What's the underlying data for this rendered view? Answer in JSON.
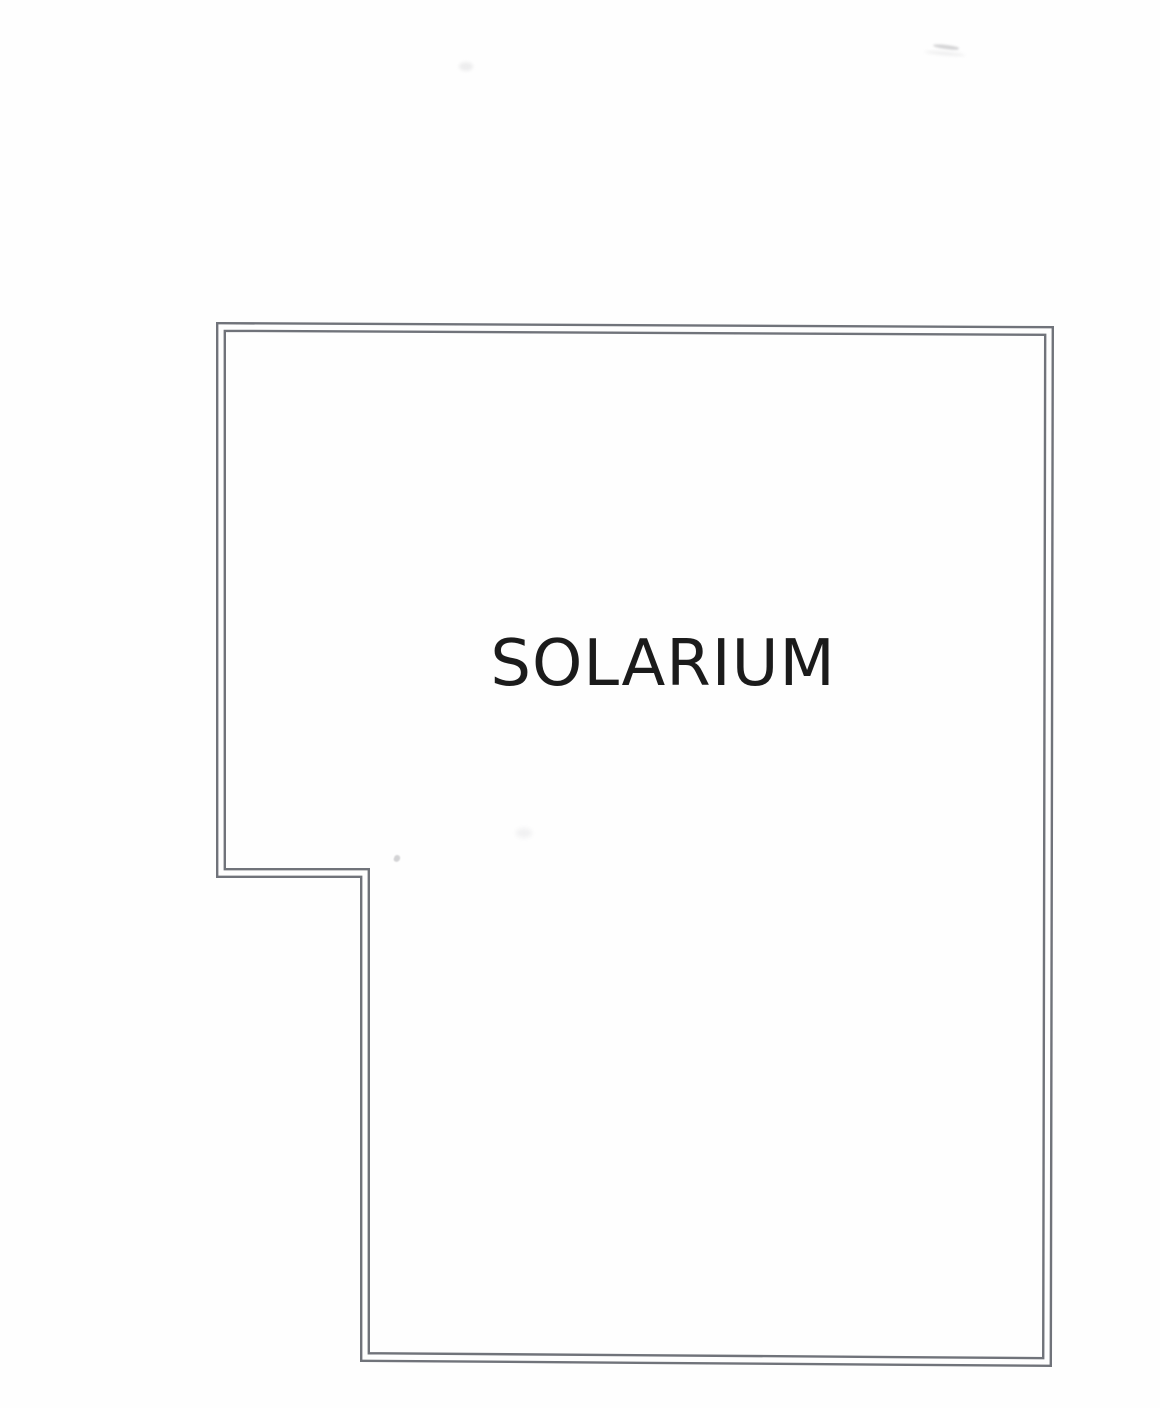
{
  "floor_plan": {
    "room_label": "SOLARIUM",
    "label_color": "#1b1b1b",
    "wall_color": "#70737a",
    "wall_band_thickness": 10,
    "wall_gap_width": 5.2,
    "paper_color": "#fefefe",
    "outline_points": [
      [
        221,
        327
      ],
      [
        1049,
        331
      ],
      [
        1047,
        1362
      ],
      [
        365,
        1357
      ],
      [
        365,
        873
      ],
      [
        221,
        873
      ]
    ]
  }
}
